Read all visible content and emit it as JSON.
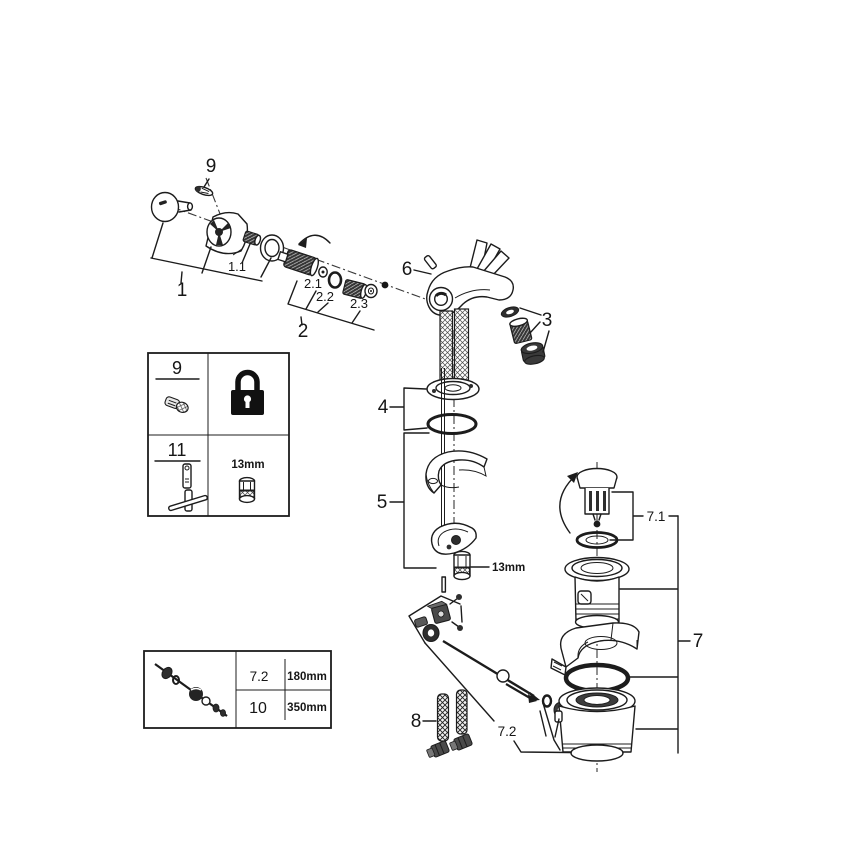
{
  "part_labels": {
    "screw": "9",
    "handle": "1",
    "handle_insert": "1.1",
    "cartridge": "2",
    "cartridge_washer": "2.1",
    "cartridge_oring": "2.2",
    "cartridge_seat": "2.3",
    "aerator": "3",
    "mounting_washers": "4",
    "mounting_clamp": "5",
    "spout": "6",
    "drain": "7",
    "drain_plug": "7.1",
    "drain_rod": "7.2",
    "hoses": "8",
    "nut_size": "13mm"
  },
  "tool_table": {
    "row1_part": "9",
    "row2_part": "11",
    "row2_tool_size": "13mm"
  },
  "size_table": {
    "rows": [
      {
        "part": "7.2",
        "length": "180mm"
      },
      {
        "part": "10",
        "length": "350mm"
      }
    ]
  }
}
